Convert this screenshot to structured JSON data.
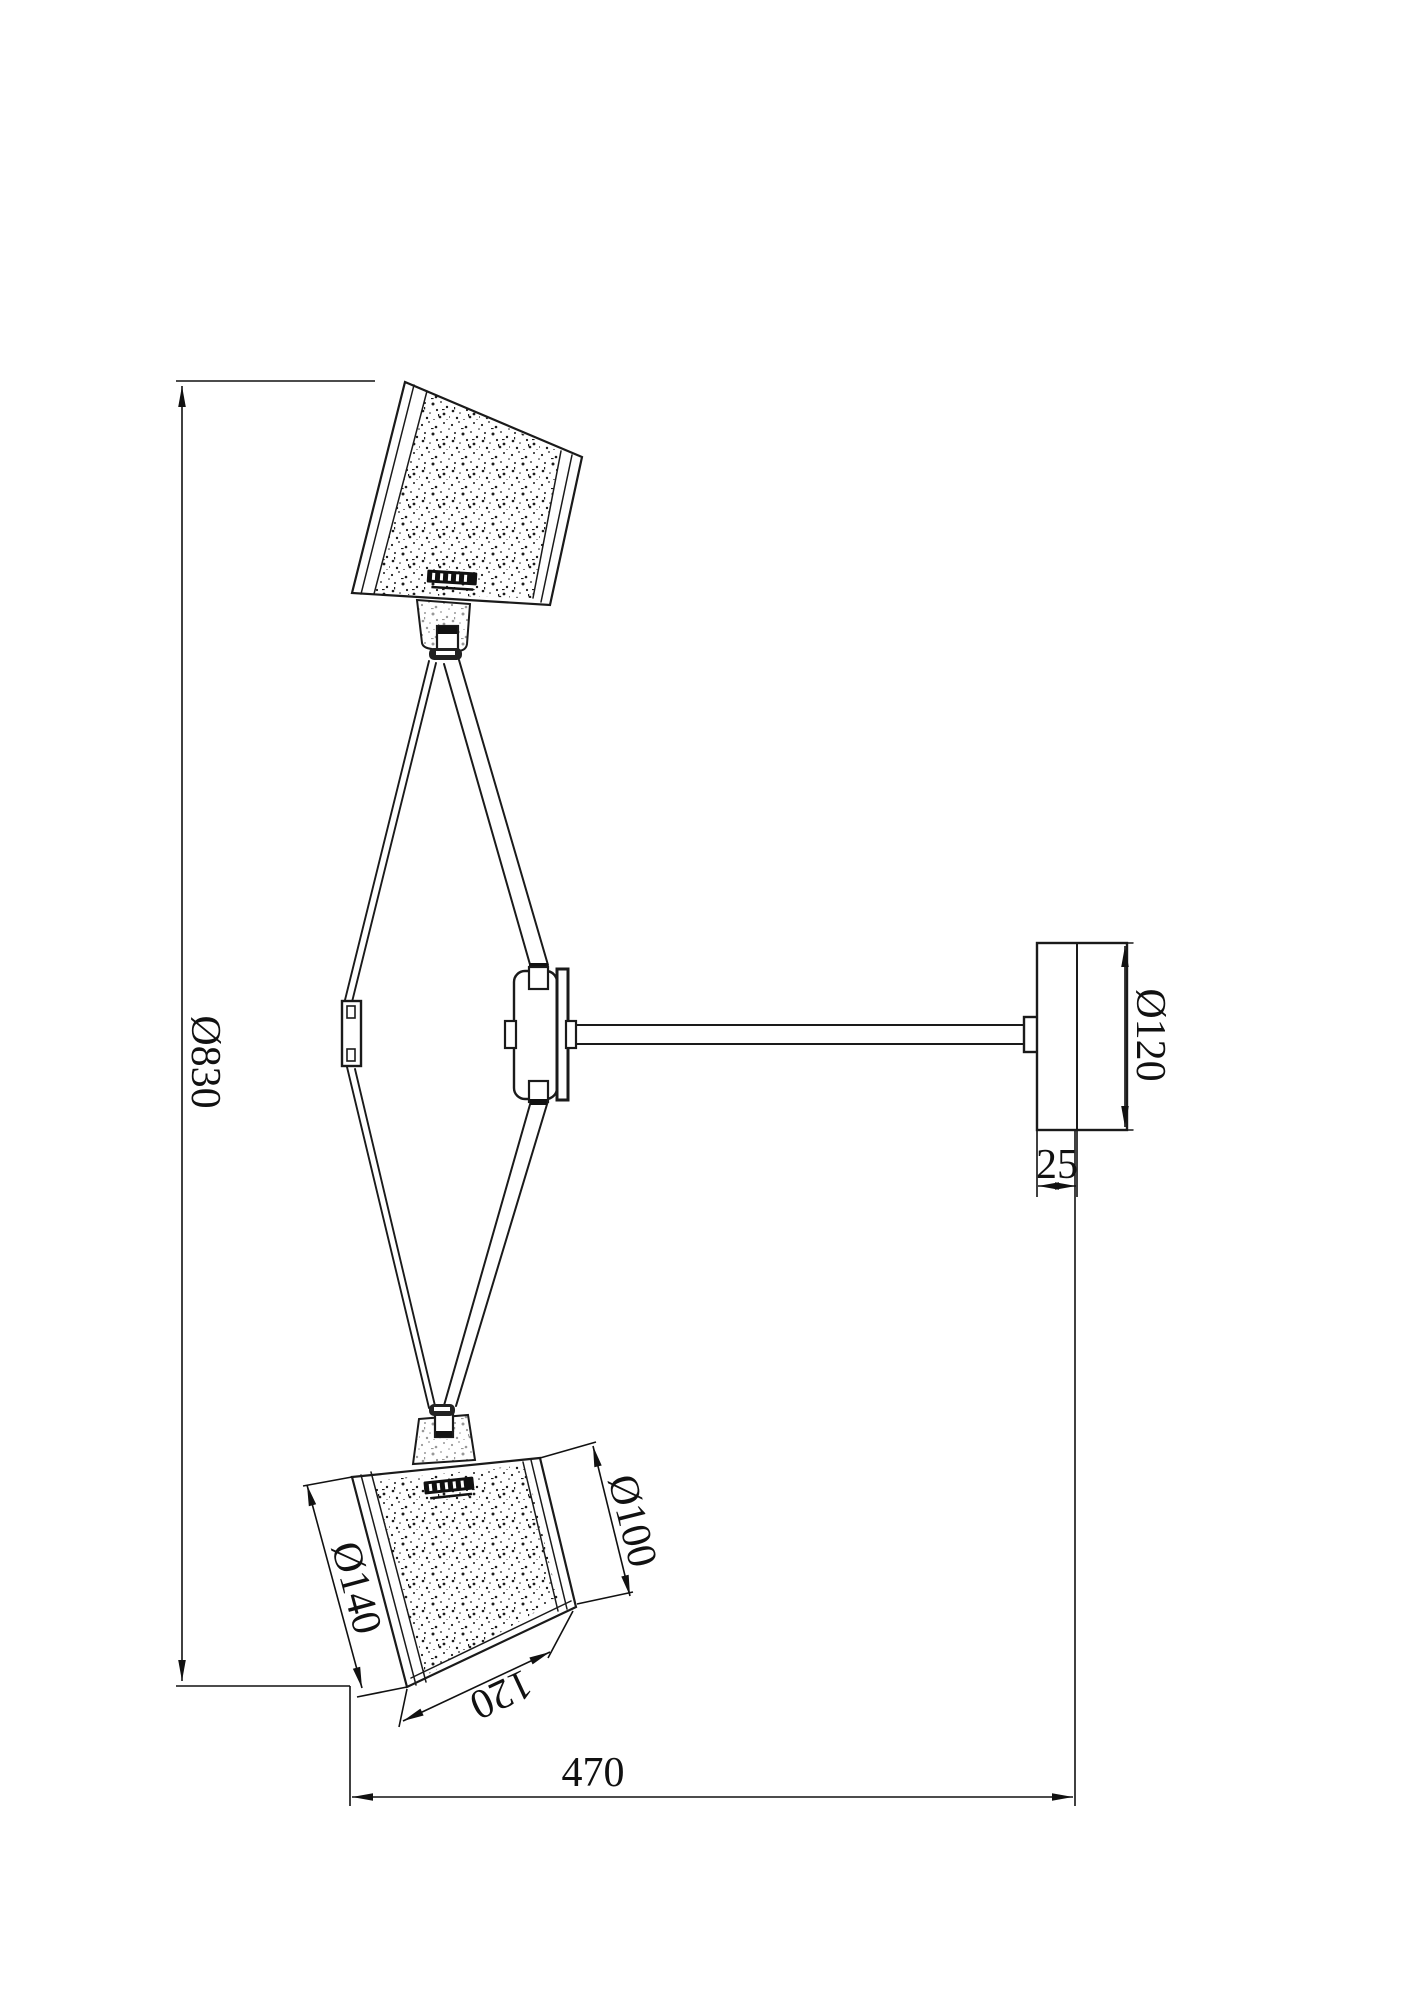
{
  "drawing": {
    "kind": "technical dimension drawing of a two-shade wall lamp",
    "line_color": "#1a1a1a",
    "background": "#ffffff",
    "dim_labels": {
      "overall_height": "Ø830",
      "plate_diameter": "Ø120",
      "plate_thickness": "25",
      "projection": "470",
      "shade_top_diameter": "Ø100",
      "shade_bottom_diameter": "Ø140",
      "shade_height": "120"
    }
  }
}
